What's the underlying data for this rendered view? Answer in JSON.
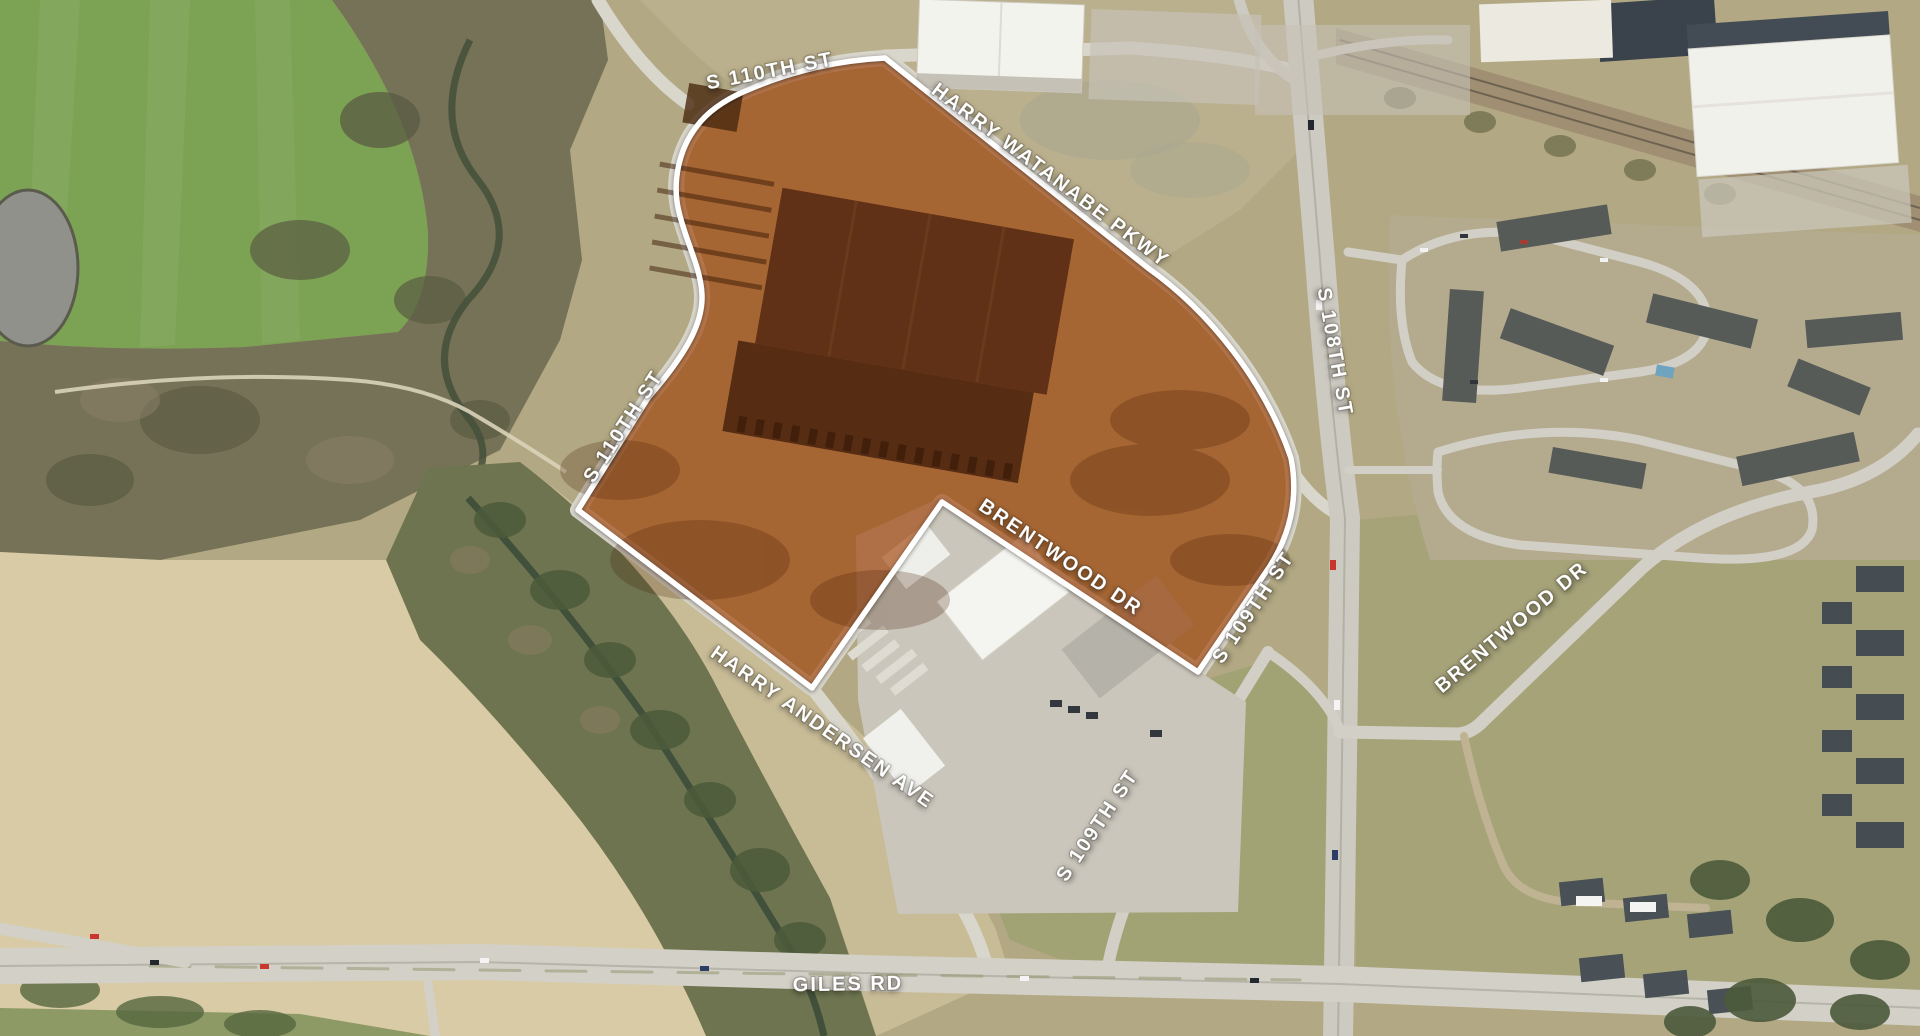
{
  "map": {
    "description": "Aerial site map with highlighted development parcel",
    "parcel": {
      "highlight_fill": "#A04208",
      "highlight_opacity": 0.65,
      "boundary_color": "#FFFFFF"
    },
    "street_labels": [
      {
        "id": "s-110th-st-top",
        "text": "S 110TH ST",
        "x": 770,
        "y": 72,
        "rotate": -11
      },
      {
        "id": "harry-watanabe-pkwy",
        "text": "HARRY WATANABE PKWY",
        "x": 1050,
        "y": 176,
        "rotate": 37
      },
      {
        "id": "s-110th-st-west",
        "text": "S 110TH ST",
        "x": 624,
        "y": 427,
        "rotate": -57
      },
      {
        "id": "s-108th-st",
        "text": "S 108TH ST",
        "x": 1334,
        "y": 352,
        "rotate": 80
      },
      {
        "id": "brentwood-dr-center",
        "text": "BRENTWOOD DR",
        "x": 1060,
        "y": 558,
        "rotate": 34
      },
      {
        "id": "s-109th-st-upper",
        "text": "S 109TH ST",
        "x": 1254,
        "y": 608,
        "rotate": -56
      },
      {
        "id": "brentwood-dr-east",
        "text": "BRENTWOOD DR",
        "x": 1512,
        "y": 628,
        "rotate": -40
      },
      {
        "id": "harry-andersen-ave",
        "text": "HARRY ANDERSEN AVE",
        "x": 822,
        "y": 728,
        "rotate": 35
      },
      {
        "id": "s-109th-st-lower",
        "text": "S 109TH ST",
        "x": 1098,
        "y": 826,
        "rotate": -56
      },
      {
        "id": "giles-rd",
        "text": "GILES RD",
        "x": 848,
        "y": 985,
        "rotate": -1
      }
    ],
    "terrain_colors": {
      "base": "#b2a883",
      "green_field": "#7ca253",
      "woodland": "#767257",
      "creek_water": "#3c4c37",
      "pale_field": "#d8cba6",
      "road": "#d7d4ca",
      "warehouse_roof": "#f3f3ee",
      "dark_roof": "#3a424b"
    }
  }
}
